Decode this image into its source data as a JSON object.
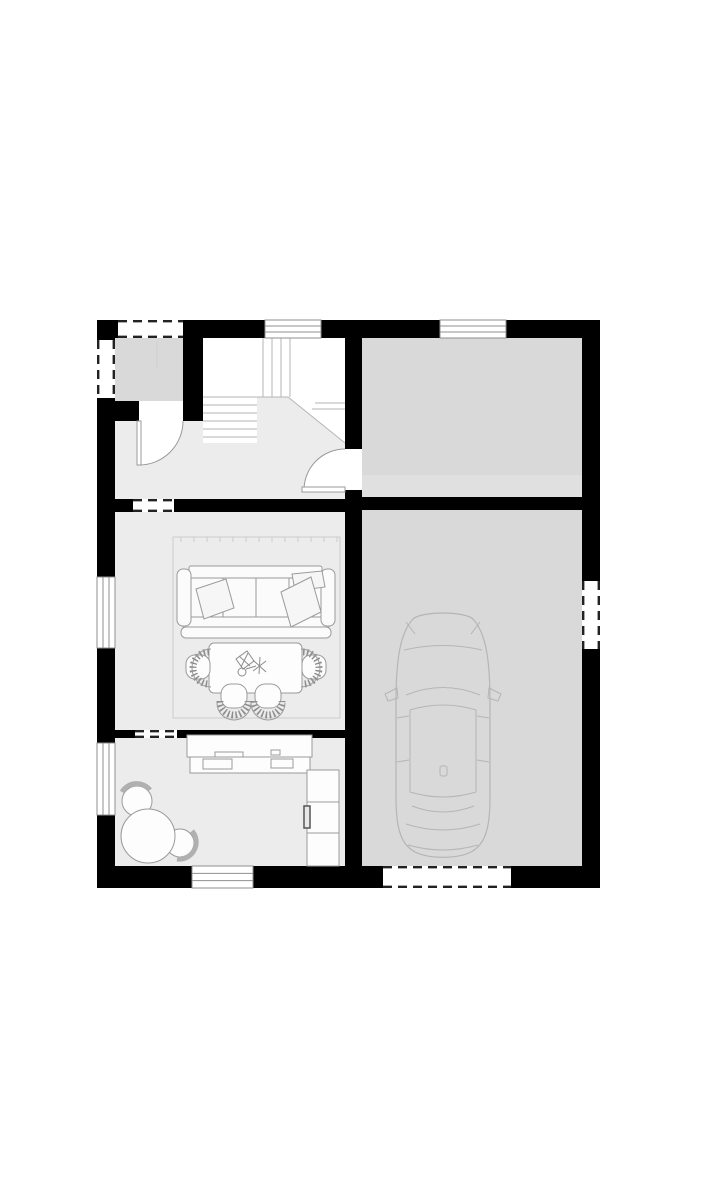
{
  "meta": {
    "title": "House ground-floor plan with garage",
    "type": "architectural-floor-plan"
  },
  "canvas": {
    "w": 717,
    "h": 1200,
    "bg": "#ffffff"
  },
  "palette": {
    "wall": "#000000",
    "floor_light": "#ececec",
    "floor_mid": "#d9d9d9",
    "floor_band": "#e0e0e0",
    "stair_bg": "#ffffff",
    "stair_line": "#b5b5b5",
    "window_line": "#8f8f8f",
    "dash_line": "#222222",
    "furniture_stroke": "#9a9a9a",
    "car_stroke": "#b5b5b5",
    "white": "#ffffff"
  },
  "rooms": [
    {
      "name": "room-entry-porch",
      "shape": "rect",
      "x": 115,
      "y": 338,
      "w": 68,
      "h": 63,
      "fill": "#d9d9d9"
    },
    {
      "name": "room-stair-area",
      "shape": "rect",
      "x": 203,
      "y": 338,
      "w": 142,
      "h": 105,
      "fill": "#ffffff"
    },
    {
      "name": "room-hallway",
      "shape": "polygon",
      "points": "115,421 203,421 203,443 257,443 257,397 288,397 345,443 345,499 115,499",
      "fill": "#ececec"
    },
    {
      "name": "room-living",
      "shape": "rect",
      "x": 115,
      "y": 512,
      "w": 230,
      "h": 218,
      "fill": "#ececec"
    },
    {
      "name": "room-kitchen",
      "shape": "rect",
      "x": 115,
      "y": 738,
      "w": 230,
      "h": 128,
      "fill": "#ececec"
    },
    {
      "name": "room-storage",
      "shape": "rect",
      "x": 362,
      "y": 338,
      "w": 220,
      "h": 159,
      "fill": "#d9d9d9"
    },
    {
      "name": "room-storage-floor-band",
      "shape": "rect",
      "x": 362,
      "y": 475,
      "w": 220,
      "h": 22,
      "fill": "#e0e0e0"
    },
    {
      "name": "room-garage",
      "shape": "rect",
      "x": 362,
      "y": 510,
      "w": 220,
      "h": 356,
      "fill": "#d9d9d9"
    }
  ],
  "stairs": {
    "name": "staircase",
    "lines": [
      {
        "x1": 263,
        "y1": 338,
        "x2": 263,
        "y2": 397
      },
      {
        "x1": 272,
        "y1": 338,
        "x2": 272,
        "y2": 397
      },
      {
        "x1": 281,
        "y1": 338,
        "x2": 281,
        "y2": 397
      },
      {
        "x1": 290,
        "y1": 338,
        "x2": 290,
        "y2": 397
      },
      {
        "x1": 203,
        "y1": 397,
        "x2": 288,
        "y2": 397
      },
      {
        "x1": 203,
        "y1": 405,
        "x2": 257,
        "y2": 405
      },
      {
        "x1": 203,
        "y1": 413,
        "x2": 257,
        "y2": 413
      },
      {
        "x1": 203,
        "y1": 421,
        "x2": 257,
        "y2": 421
      },
      {
        "x1": 203,
        "y1": 429,
        "x2": 257,
        "y2": 429
      },
      {
        "x1": 203,
        "y1": 437,
        "x2": 257,
        "y2": 437
      },
      {
        "x1": 315,
        "y1": 403,
        "x2": 345,
        "y2": 403
      },
      {
        "x1": 312,
        "y1": 409,
        "x2": 345,
        "y2": 409
      },
      {
        "x1": 288,
        "y1": 397,
        "x2": 345,
        "y2": 443
      }
    ]
  },
  "walls": [
    {
      "name": "wall-top",
      "x": 97,
      "y": 320,
      "w": 503,
      "h": 18
    },
    {
      "name": "wall-bottom",
      "x": 97,
      "y": 866,
      "w": 503,
      "h": 22
    },
    {
      "name": "wall-left",
      "x": 97,
      "y": 320,
      "w": 18,
      "h": 568
    },
    {
      "name": "wall-right",
      "x": 582,
      "y": 320,
      "w": 18,
      "h": 568
    },
    {
      "name": "wall-garage-separator",
      "x": 345,
      "y": 338,
      "w": 17,
      "h": 528
    },
    {
      "name": "wall-hall-living",
      "x": 97,
      "y": 499,
      "w": 248,
      "h": 13
    },
    {
      "name": "wall-storage-garage",
      "x": 362,
      "y": 497,
      "w": 220,
      "h": 13
    },
    {
      "name": "wall-living-kitchen",
      "x": 97,
      "y": 730,
      "w": 248,
      "h": 8
    },
    {
      "name": "wall-porch-bottom",
      "x": 97,
      "y": 401,
      "w": 42,
      "h": 20
    },
    {
      "name": "wall-porch-right",
      "x": 183,
      "y": 338,
      "w": 20,
      "h": 83
    }
  ],
  "door_gaps": [
    {
      "name": "doorway-entry",
      "x": 139,
      "y": 401,
      "w": 44,
      "h": 20
    },
    {
      "name": "doorway-hall-storage",
      "x": 345,
      "y": 449,
      "w": 17,
      "h": 41
    }
  ],
  "windows": [
    {
      "name": "window-top-1",
      "x": 265,
      "y": 320,
      "w": 56,
      "h": 18,
      "dir": "h"
    },
    {
      "name": "window-top-2",
      "x": 440,
      "y": 320,
      "w": 66,
      "h": 18,
      "dir": "h"
    },
    {
      "name": "window-left-1",
      "x": 97,
      "y": 577,
      "w": 18,
      "h": 71,
      "dir": "v"
    },
    {
      "name": "window-left-2",
      "x": 97,
      "y": 743,
      "w": 18,
      "h": 72,
      "dir": "v"
    },
    {
      "name": "window-bottom",
      "x": 192,
      "y": 866,
      "w": 61,
      "h": 22,
      "dir": "h"
    }
  ],
  "dashed_openings": [
    {
      "name": "opening-porch-top",
      "x": 118,
      "y": 320,
      "w": 65,
      "h": 18,
      "dir": "h"
    },
    {
      "name": "opening-porch-left",
      "x": 97,
      "y": 340,
      "w": 18,
      "h": 58,
      "dir": "v"
    },
    {
      "name": "opening-hall-living",
      "x": 133,
      "y": 499,
      "w": 41,
      "h": 13,
      "dir": "h"
    },
    {
      "name": "opening-living-kitchen",
      "x": 135,
      "y": 730,
      "w": 42,
      "h": 8,
      "dir": "h"
    },
    {
      "name": "opening-garage-side",
      "x": 582,
      "y": 581,
      "w": 18,
      "h": 68,
      "dir": "v"
    },
    {
      "name": "opening-garage-door",
      "x": 383,
      "y": 866,
      "w": 128,
      "h": 22,
      "dir": "h"
    }
  ],
  "doors": [
    {
      "name": "door-entry",
      "wedge": "M 139 421 L 183 421 A 44 44 0 0 1 139 465 Z",
      "arc": "M 183 421 A 44 44 0 0 1 139 465",
      "leaf": {
        "x": 137,
        "y": 421,
        "w": 4,
        "h": 44
      }
    },
    {
      "name": "door-hall-storage",
      "wedge": "M 345 490 L 345 449 A 41 41 0 0 0 304 490 Z",
      "arc": "M 345 449 A 41 41 0 0 0 304 490",
      "leaf": {
        "x": 302,
        "y": 487,
        "w": 43,
        "h": 5
      }
    }
  ],
  "furniture": [
    {
      "name": "area-rug",
      "items": [
        {
          "t": "rect",
          "x": 173,
          "y": 537,
          "w": 167,
          "h": 181,
          "s": "#cbcbcb"
        },
        {
          "t": "line",
          "x1": 181,
          "y1": 537,
          "x2": 181,
          "y2": 542,
          "s": "#cbcbcb"
        },
        {
          "t": "line",
          "x1": 194,
          "y1": 537,
          "x2": 194,
          "y2": 542,
          "s": "#cbcbcb"
        },
        {
          "t": "line",
          "x1": 207,
          "y1": 537,
          "x2": 207,
          "y2": 542,
          "s": "#cbcbcb"
        },
        {
          "t": "line",
          "x1": 220,
          "y1": 537,
          "x2": 220,
          "y2": 542,
          "s": "#cbcbcb"
        },
        {
          "t": "line",
          "x1": 233,
          "y1": 537,
          "x2": 233,
          "y2": 542,
          "s": "#cbcbcb"
        },
        {
          "t": "line",
          "x1": 246,
          "y1": 537,
          "x2": 246,
          "y2": 542,
          "s": "#cbcbcb"
        },
        {
          "t": "line",
          "x1": 259,
          "y1": 537,
          "x2": 259,
          "y2": 542,
          "s": "#cbcbcb"
        },
        {
          "t": "line",
          "x1": 272,
          "y1": 537,
          "x2": 272,
          "y2": 542,
          "s": "#cbcbcb"
        },
        {
          "t": "line",
          "x1": 285,
          "y1": 537,
          "x2": 285,
          "y2": 542,
          "s": "#cbcbcb"
        },
        {
          "t": "line",
          "x1": 298,
          "y1": 537,
          "x2": 298,
          "y2": 542,
          "s": "#cbcbcb"
        },
        {
          "t": "line",
          "x1": 311,
          "y1": 537,
          "x2": 311,
          "y2": 542,
          "s": "#cbcbcb"
        },
        {
          "t": "line",
          "x1": 324,
          "y1": 537,
          "x2": 324,
          "y2": 542,
          "s": "#cbcbcb"
        },
        {
          "t": "line",
          "x1": 337,
          "y1": 537,
          "x2": 337,
          "y2": 542,
          "s": "#cbcbcb"
        }
      ]
    },
    {
      "name": "sofa",
      "items": [
        {
          "t": "rect",
          "x": 189,
          "y": 566,
          "w": 133,
          "h": 12,
          "rx": 2,
          "f": "#fbfbfb"
        },
        {
          "t": "rect",
          "x": 189,
          "y": 578,
          "w": 132,
          "h": 39,
          "f": "#fbfbfb"
        },
        {
          "t": "line",
          "x1": 223,
          "y1": 578,
          "x2": 223,
          "y2": 617
        },
        {
          "t": "line",
          "x1": 256,
          "y1": 578,
          "x2": 256,
          "y2": 617
        },
        {
          "t": "line",
          "x1": 289,
          "y1": 578,
          "x2": 289,
          "y2": 617
        },
        {
          "t": "rect",
          "x": 183,
          "y": 617,
          "w": 146,
          "h": 12,
          "rx": 3,
          "f": "#fbfbfb"
        },
        {
          "t": "rect",
          "x": 181,
          "y": 627,
          "w": 150,
          "h": 11,
          "rx": 5,
          "f": "#fbfbfb"
        },
        {
          "t": "rect",
          "x": 177,
          "y": 569,
          "w": 14,
          "h": 57,
          "rx": 6,
          "f": "#fbfbfb"
        },
        {
          "t": "rect",
          "x": 321,
          "y": 569,
          "w": 14,
          "h": 57,
          "rx": 6,
          "f": "#fbfbfb"
        },
        {
          "t": "polygon",
          "pts": "196,589 226,579 234,608 204,619",
          "f": "#f6f6f6"
        },
        {
          "t": "polygon",
          "pts": "292,574 322,571 325,587 295,591",
          "f": "#f6f6f6"
        },
        {
          "t": "polygon",
          "pts": "281,592 311,577 321,612 291,627",
          "f": "#f6f6f6"
        }
      ]
    },
    {
      "name": "coffee-table",
      "items": [
        {
          "t": "rect",
          "x": 209,
          "y": 643,
          "w": 93,
          "h": 50,
          "rx": 5,
          "f": "#fdfdfd"
        },
        {
          "t": "polygon",
          "pts": "236,659 247,651 254,661 243,669",
          "s": "#8d8d8d"
        },
        {
          "t": "line",
          "x1": 239,
          "y1": 656,
          "x2": 250,
          "y2": 666,
          "s": "#8d8d8d"
        },
        {
          "t": "line",
          "x1": 248,
          "y1": 653,
          "x2": 241,
          "y2": 667,
          "s": "#8d8d8d"
        },
        {
          "t": "circle",
          "cx": 242,
          "cy": 672,
          "r": 4,
          "s": "#8d8d8d"
        },
        {
          "t": "line",
          "x1": 253,
          "y1": 660,
          "x2": 266,
          "y2": 672,
          "s": "#8d8d8d"
        },
        {
          "t": "line",
          "x1": 266,
          "y1": 661,
          "x2": 253,
          "y2": 671,
          "s": "#8d8d8d"
        },
        {
          "t": "line",
          "x1": 260,
          "y1": 657,
          "x2": 259,
          "y2": 674,
          "s": "#8d8d8d"
        },
        {
          "t": "line",
          "x1": 246,
          "y1": 669,
          "x2": 256,
          "y2": 666,
          "s": "#8d8d8d"
        }
      ]
    },
    {
      "name": "armchair-left",
      "items": [
        {
          "t": "rect",
          "x": 186,
          "y": 655,
          "w": 24,
          "h": 24,
          "rx": 9,
          "f": "#fdfdfd"
        },
        {
          "t": "path",
          "d": "M 209 652 A 16 16 0 0 0 209 684",
          "s": "#8e8e8e",
          "sw": 7,
          "da": "1.6 2.3"
        },
        {
          "t": "path",
          "d": "M 211 649 A 19 19 0 0 0 211 687"
        }
      ]
    },
    {
      "name": "armchair-right",
      "items": [
        {
          "t": "rect",
          "x": 302,
          "y": 655,
          "w": 24,
          "h": 24,
          "rx": 9,
          "f": "#fdfdfd"
        },
        {
          "t": "path",
          "d": "M 303 652 A 16 16 0 0 1 303 684",
          "s": "#8e8e8e",
          "sw": 7,
          "da": "1.6 2.3"
        },
        {
          "t": "path",
          "d": "M 301 649 A 19 19 0 0 1 301 687"
        }
      ]
    },
    {
      "name": "chair-bottom-1",
      "items": [
        {
          "t": "rect",
          "x": 221,
          "y": 684,
          "w": 26,
          "h": 24,
          "rx": 10,
          "f": "#fdfdfd"
        },
        {
          "t": "path",
          "d": "M 220 701 A 14 14 0 0 0 248 701",
          "s": "#8e8e8e",
          "sw": 7,
          "da": "1.6 2.3"
        },
        {
          "t": "path",
          "d": "M 217 703 A 17 17 0 0 0 251 703"
        }
      ]
    },
    {
      "name": "chair-bottom-2",
      "items": [
        {
          "t": "rect",
          "x": 255,
          "y": 684,
          "w": 26,
          "h": 24,
          "rx": 10,
          "f": "#fdfdfd"
        },
        {
          "t": "path",
          "d": "M 254 701 A 14 14 0 0 0 282 701",
          "s": "#8e8e8e",
          "sw": 7,
          "da": "1.6 2.3"
        },
        {
          "t": "path",
          "d": "M 251 703 A 17 17 0 0 0 285 703"
        }
      ]
    },
    {
      "name": "kitchen-counter",
      "items": [
        {
          "t": "rect",
          "x": 187,
          "y": 735,
          "w": 125,
          "h": 22,
          "f": "#fdfdfd"
        },
        {
          "t": "rect",
          "x": 190,
          "y": 757,
          "w": 120,
          "h": 16,
          "f": "#fdfdfd"
        },
        {
          "t": "rect",
          "x": 203,
          "y": 759,
          "w": 29,
          "h": 10
        },
        {
          "t": "rect",
          "x": 271,
          "y": 759,
          "w": 22,
          "h": 9
        },
        {
          "t": "rect",
          "x": 215,
          "y": 752,
          "w": 28,
          "h": 5
        },
        {
          "t": "rect",
          "x": 271,
          "y": 750,
          "w": 9,
          "h": 5
        },
        {
          "t": "rect",
          "x": 307,
          "y": 770,
          "w": 32,
          "h": 96,
          "f": "#fdfdfd"
        },
        {
          "t": "line",
          "x1": 307,
          "y1": 802,
          "x2": 339,
          "y2": 802
        },
        {
          "t": "line",
          "x1": 307,
          "y1": 833,
          "x2": 339,
          "y2": 833
        },
        {
          "t": "rect",
          "x": 304,
          "y": 806,
          "w": 6,
          "h": 22,
          "f": "#e8e8e8",
          "s": "#555555",
          "sw": 1.5
        }
      ]
    },
    {
      "name": "breakfast-table-set",
      "items": [
        {
          "t": "circle",
          "cx": 137,
          "cy": 801,
          "r": 15,
          "f": "#fdfdfd"
        },
        {
          "t": "path",
          "d": "M 122 792 A 17 17 0 0 1 150 790",
          "s": "#b0b0b0",
          "sw": 5
        },
        {
          "t": "circle",
          "cx": 180,
          "cy": 843,
          "r": 14,
          "f": "#fdfdfd"
        },
        {
          "t": "path",
          "d": "M 192 831 A 17 17 0 0 1 177 859",
          "s": "#b0b0b0",
          "sw": 5
        },
        {
          "t": "circle",
          "cx": 148,
          "cy": 836,
          "r": 27,
          "f": "#fdfdfd"
        }
      ]
    },
    {
      "name": "car",
      "stroke": "#b5b5b5",
      "items": [
        {
          "t": "path",
          "d": "M 396 702 C 396 656 401 632 413 619 C 422 611 464 611 473 619 C 485 632 490 656 490 702 L 490 798 C 490 831 484 845 471 852 C 457 859 429 859 415 852 C 402 845 396 831 396 798 Z",
          "s": "#b5b5b5",
          "sw": 1.2
        },
        {
          "t": "path",
          "d": "M 404 650 Q 443 641 482 650",
          "s": "#b5b5b5"
        },
        {
          "t": "line",
          "x1": 406,
          "y1": 622,
          "x2": 415,
          "y2": 634,
          "s": "#b5b5b5"
        },
        {
          "t": "line",
          "x1": 480,
          "y1": 622,
          "x2": 471,
          "y2": 634,
          "s": "#b5b5b5"
        },
        {
          "t": "path",
          "d": "M 406 695 Q 443 680 480 695",
          "s": "#b5b5b5"
        },
        {
          "t": "path",
          "d": "M 410 710 Q 443 700 476 710 L 476 792 Q 443 802 410 792 Z",
          "s": "#b5b5b5"
        },
        {
          "t": "path",
          "d": "M 412 806 Q 443 818 474 806",
          "s": "#b5b5b5"
        },
        {
          "t": "path",
          "d": "M 406 824 Q 443 836 480 824",
          "s": "#b5b5b5"
        },
        {
          "t": "path",
          "d": "M 408 845 Q 443 855 478 845",
          "s": "#b5b5b5"
        },
        {
          "t": "polygon",
          "pts": "397,688 385,694 388,701 398,698",
          "s": "#b5b5b5"
        },
        {
          "t": "polygon",
          "pts": "489,688 501,694 498,701 488,698",
          "s": "#b5b5b5"
        },
        {
          "t": "rect",
          "x": 440,
          "y": 766,
          "w": 7,
          "h": 10,
          "rx": 2,
          "s": "#b5b5b5"
        },
        {
          "t": "line",
          "x1": 397,
          "y1": 718,
          "x2": 409,
          "y2": 716,
          "s": "#b5b5b5"
        },
        {
          "t": "line",
          "x1": 477,
          "y1": 716,
          "x2": 489,
          "y2": 718,
          "s": "#b5b5b5"
        },
        {
          "t": "line",
          "x1": 397,
          "y1": 762,
          "x2": 409,
          "y2": 760,
          "s": "#b5b5b5"
        },
        {
          "t": "line",
          "x1": 477,
          "y1": 760,
          "x2": 489,
          "y2": 762,
          "s": "#b5b5b5"
        }
      ]
    },
    {
      "name": "porch-detail",
      "items": [
        {
          "t": "line",
          "x1": 157,
          "y1": 341,
          "x2": 157,
          "y2": 368,
          "s": "#cfcfcf"
        }
      ]
    }
  ]
}
